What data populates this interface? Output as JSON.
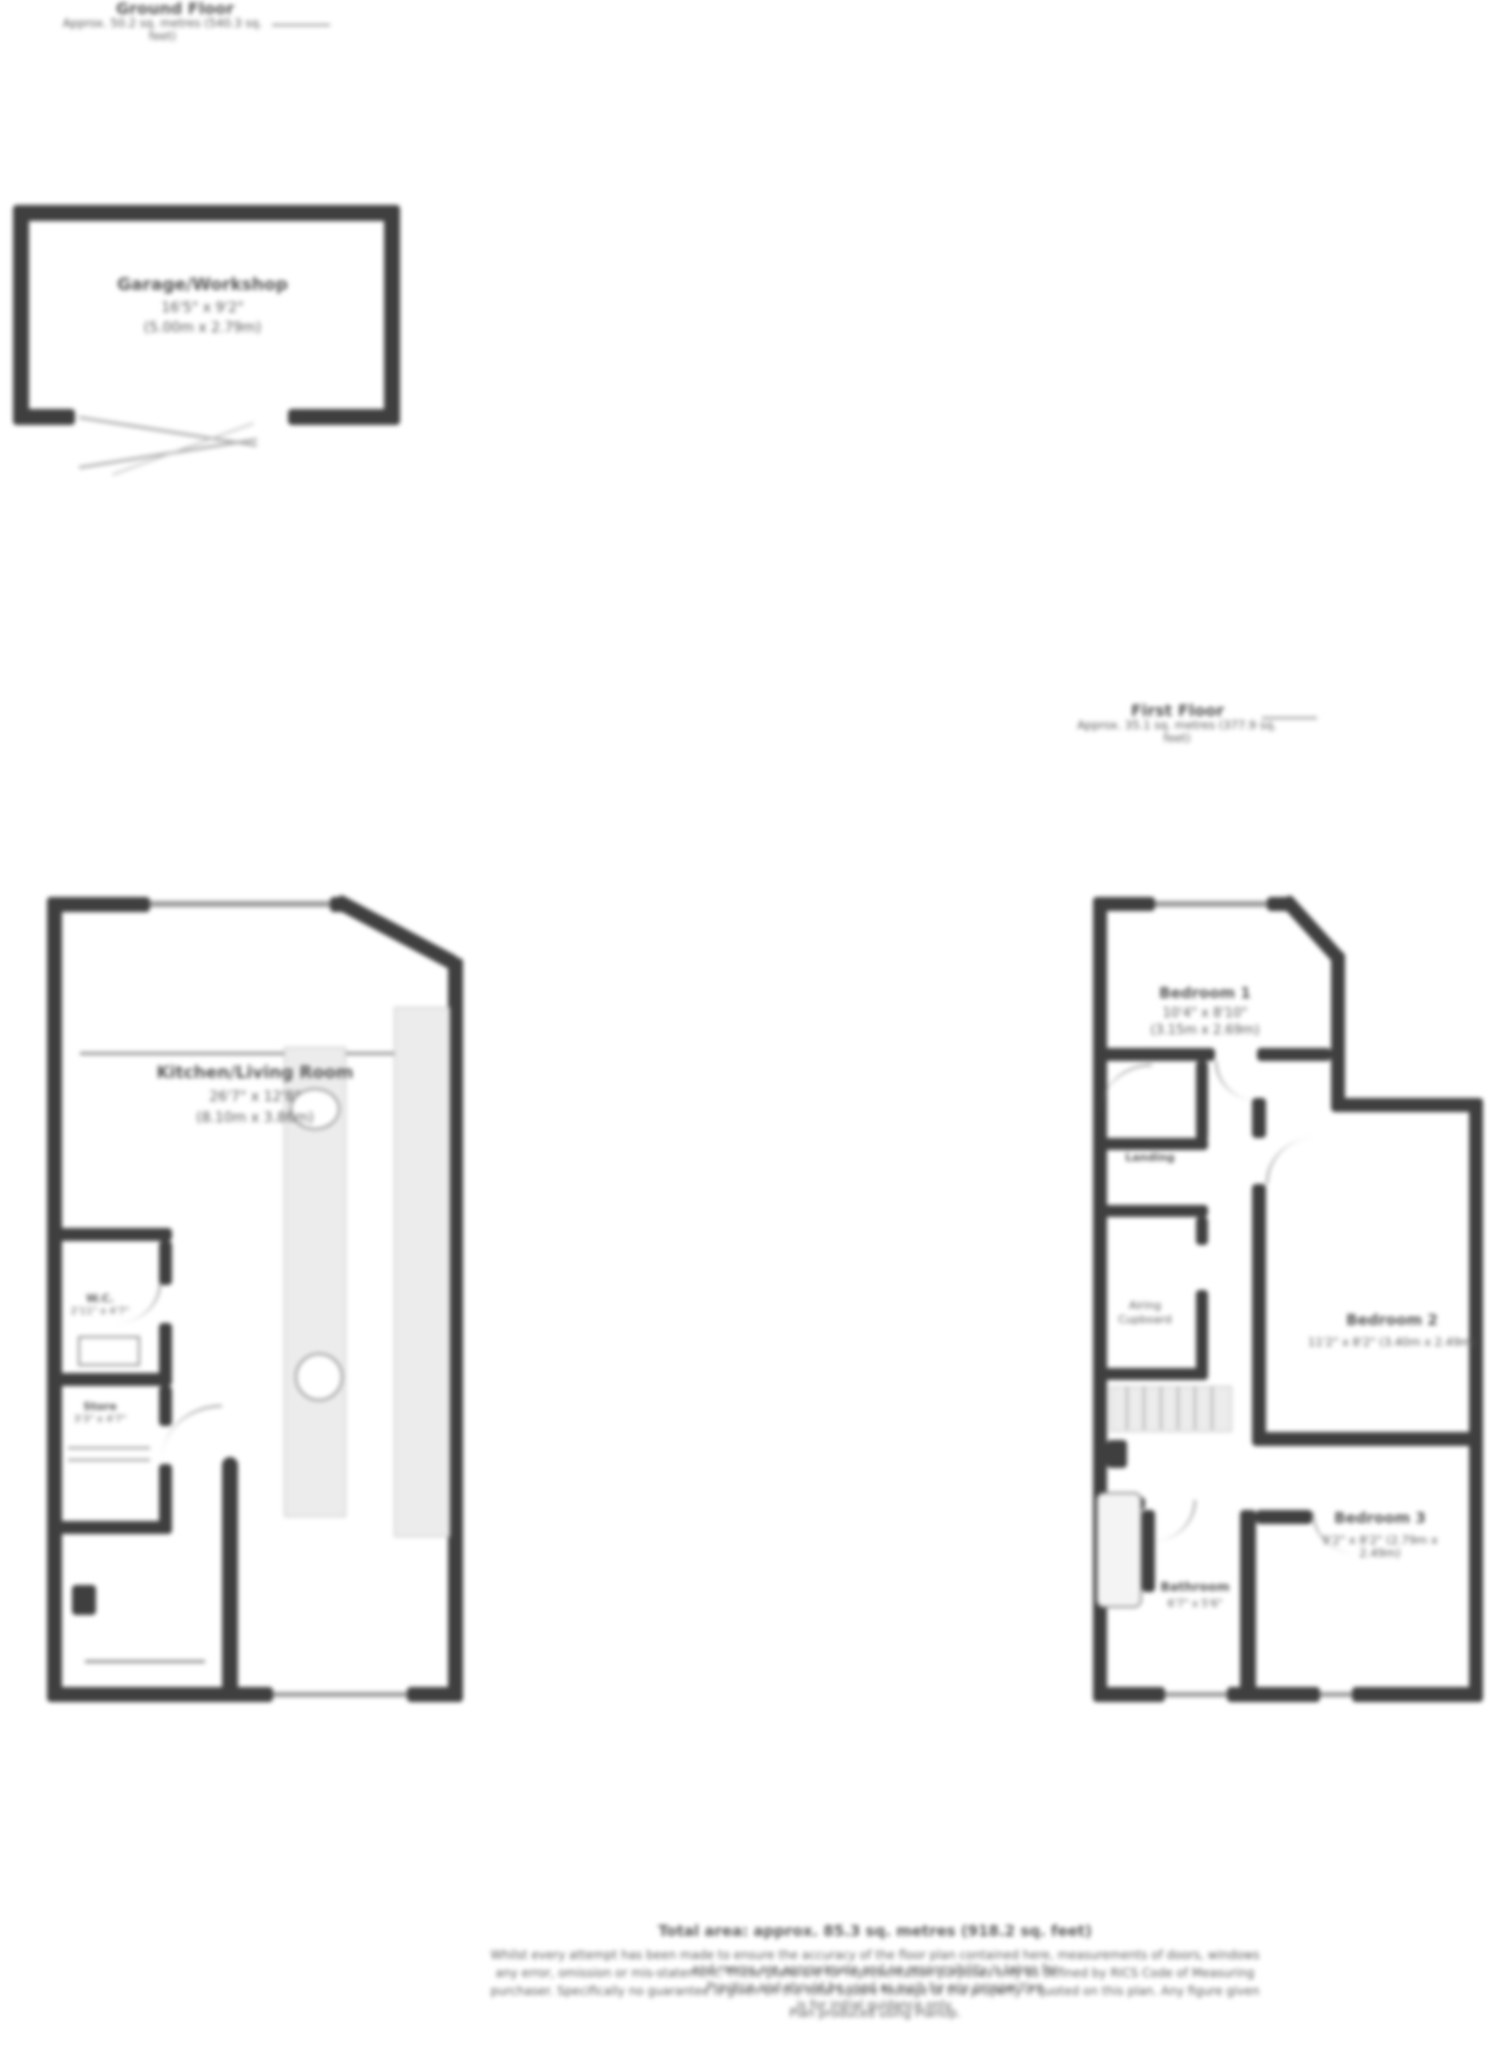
{
  "ground_floor": {
    "header_title": "Ground Floor",
    "header_area": "Approx. 50.2 sq. metres (540.3 sq. feet)",
    "garage": {
      "name": "Garage/Workshop",
      "dims": "16'5\" x 9'2\"",
      "metric": "(5.00m x 2.79m)"
    },
    "living": {
      "name": "Kitchen/Living Room",
      "dims": "26'7\" x 12'8\"",
      "metric": "(8.10m x 3.86m)"
    },
    "wc": {
      "name": "W.C.",
      "dims": "2'11\" x 4'7\""
    },
    "store": {
      "name": "Store",
      "dims": "3'3\" x 4'7\""
    }
  },
  "first_floor": {
    "header_title": "First Floor",
    "header_area": "Approx. 35.1 sq. metres (377.9 sq. feet)",
    "bedroom1": {
      "name": "Bedroom 1",
      "dims": "10'4\" x 8'10\"",
      "metric": "(3.15m x 2.69m)"
    },
    "bedroom2": {
      "name": "Bedroom 2",
      "dims": "11'2\" x 8'2\" (3.40m x 2.49m)"
    },
    "bedroom3": {
      "name": "Bedroom 3",
      "dims": "9'2\" x 8'2\" (2.79m x 2.49m)"
    },
    "bathroom": {
      "name": "Bathroom",
      "dims": "6'7\" x 5'6\""
    },
    "landing": {
      "name": "Landing"
    },
    "cupboard": {
      "line1": "Airing",
      "line2": "Cupboard"
    }
  },
  "footer": {
    "total_area": "Total area: approx. 85.3 sq. metres (918.2 sq. feet)",
    "disclaimer1": "Whilst every attempt has been made to ensure the accuracy of the floor plan contained here, measurements of doors, windows and rooms are approximate and no responsibility is taken for",
    "disclaimer2": "any error, omission or mis-statement. These plans are for representation purposes only as defined by RICS Code of Measuring Practice and should be used as such by any prospective",
    "disclaimer3": "purchaser. Specifically no guarantee is given on the total square footage of the property if quoted on this plan. Any figure given is for initial guidance only.",
    "credit": "Plan produced using PlanUp."
  },
  "colors": {
    "wall": "#3f3f3f",
    "light_fill": "#ececec",
    "text": "#565656"
  }
}
